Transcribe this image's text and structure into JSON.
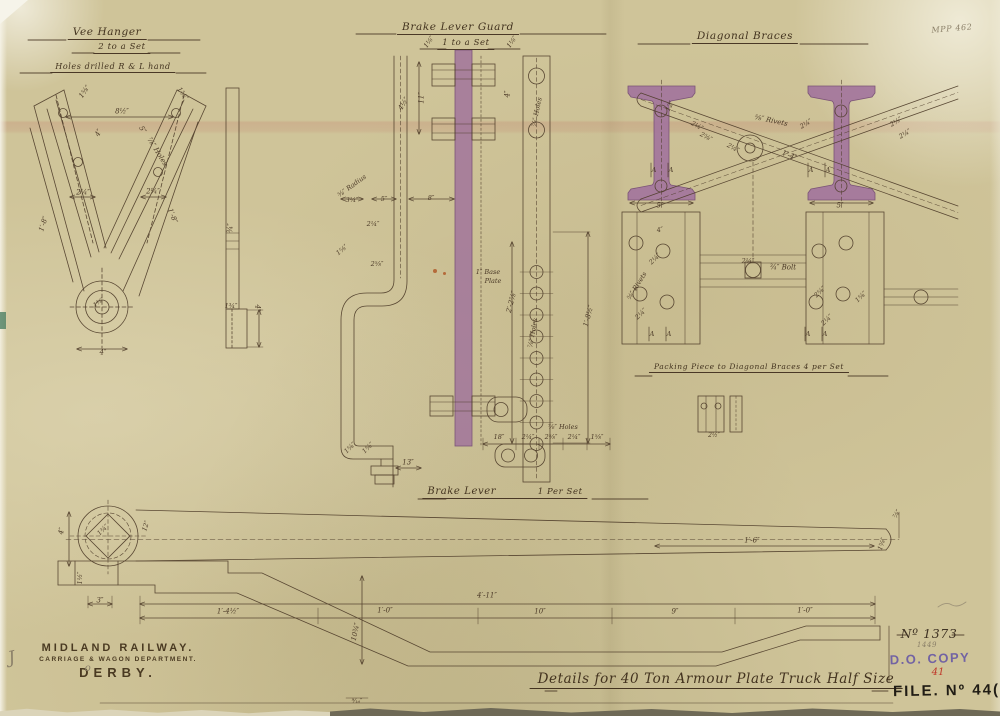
{
  "sheet": {
    "corner_note": "MPP 462",
    "pencil_mark_1": "J",
    "pencil_mark_2": "o"
  },
  "sections": {
    "vee_hanger": {
      "title": "Vee Hanger",
      "subtitle": "2 to a Set",
      "note": "Holes drilled R & L hand"
    },
    "brake_lever_guard": {
      "title": "Brake Lever Guard",
      "subtitle": "1 to a Set"
    },
    "diagonal_braces": {
      "title": "Diagonal Braces"
    },
    "packing_piece": {
      "label": "Packing Piece to Diagonal Braces    4 per Set"
    },
    "brake_lever": {
      "title": "Brake Lever",
      "subtitle": "1 Per Set"
    }
  },
  "title_block": {
    "company": "MIDLAND RAILWAY.",
    "department": "CARRIAGE & WAGON DEPARTMENT.",
    "location": "DERBY.",
    "main_title": "Details for 40 Ton Armour Plate Truck    Half Size"
  },
  "stamps": {
    "drawing_number": "Nº 1373",
    "pencil_number": "1449",
    "do_copy": "D.O. COPY",
    "red_note": "41",
    "file_stamp": "FILE. Nº 44(XX"
  },
  "colors": {
    "paper": "#cfc499",
    "ink": "#4f3d2a",
    "highlight_mauve": "#a1749b",
    "stamp_purple": "#6656a5",
    "stamp_red": "#c0392b"
  },
  "annotations": [
    {
      "text": "1⅝″",
      "x": 85,
      "y": 92,
      "rot": -55
    },
    {
      "text": "1⅝″",
      "x": 182,
      "y": 94,
      "rot": 55
    },
    {
      "text": "8½″",
      "x": 122,
      "y": 112
    },
    {
      "text": "4″",
      "x": 99,
      "y": 133,
      "rot": -62
    },
    {
      "text": "5″",
      "x": 142,
      "y": 130,
      "rot": 58
    },
    {
      "text": "⅞″ Holes",
      "x": 157,
      "y": 152,
      "rot": 58
    },
    {
      "text": "2¼″",
      "x": 83,
      "y": 193
    },
    {
      "text": "2¼″",
      "x": 153,
      "y": 192
    },
    {
      "text": "1′-8″",
      "x": 44,
      "y": 224,
      "rot": -72
    },
    {
      "text": "1′-8″",
      "x": 172,
      "y": 216,
      "rot": 68
    },
    {
      "text": "1⅜″",
      "x": 99,
      "y": 303,
      "rot": -35,
      "size": 6
    },
    {
      "text": "4″",
      "x": 103,
      "y": 353
    },
    {
      "text": "¾″",
      "x": 231,
      "y": 228,
      "rot": -90
    },
    {
      "text": "1¾″",
      "x": 231,
      "y": 306,
      "size": 6.5
    },
    {
      "text": "4″",
      "x": 257,
      "y": 308,
      "rot": 90
    },
    {
      "text": "1⅛″",
      "x": 429,
      "y": 42,
      "rot": -55,
      "size": 6.5
    },
    {
      "text": "1⅛″",
      "x": 512,
      "y": 42,
      "rot": -55,
      "size": 6.5
    },
    {
      "text": "4½″",
      "x": 404,
      "y": 104,
      "rot": -58
    },
    {
      "text": "11″",
      "x": 422,
      "y": 98,
      "rot": -90
    },
    {
      "text": "4″",
      "x": 508,
      "y": 94,
      "rot": -90
    },
    {
      "text": "⅞″ Holes",
      "x": 537,
      "y": 112,
      "rot": -78,
      "size": 6.5
    },
    {
      "text": "⅝″ Radius",
      "x": 352,
      "y": 186,
      "rot": -36,
      "size": 6.5
    },
    {
      "text": "3¼″",
      "x": 352,
      "y": 200,
      "size": 6.5
    },
    {
      "text": "5″",
      "x": 384,
      "y": 199,
      "size": 6.5
    },
    {
      "text": "8″",
      "x": 431,
      "y": 198,
      "size": 6.5
    },
    {
      "text": "2¼″",
      "x": 373,
      "y": 224,
      "size": 6.5
    },
    {
      "text": "1⅝″",
      "x": 342,
      "y": 250,
      "rot": -40,
      "size": 6.5
    },
    {
      "text": "2⅝″",
      "x": 377,
      "y": 264,
      "size": 6.5
    },
    {
      "text": "2′-2⅞″",
      "x": 512,
      "y": 302,
      "rot": -75
    },
    {
      "text": "⅞″ Holes",
      "x": 533,
      "y": 333,
      "rot": -80,
      "size": 6.5
    },
    {
      "text": "1′-8½″",
      "x": 589,
      "y": 316,
      "rot": -75
    },
    {
      "text": "1″ Base",
      "x": 488,
      "y": 272,
      "size": 6.5
    },
    {
      "text": "Plate",
      "x": 493,
      "y": 281,
      "size": 6.5
    },
    {
      "text": "⅞″ Holes",
      "x": 563,
      "y": 427,
      "size": 6.5
    },
    {
      "text": "1⅝″",
      "x": 350,
      "y": 448,
      "rot": -45,
      "size": 6.5
    },
    {
      "text": "1⅝″",
      "x": 368,
      "y": 448,
      "rot": -45,
      "size": 6.5
    },
    {
      "text": "13″",
      "x": 408,
      "y": 463
    },
    {
      "text": "18″",
      "x": 499,
      "y": 437,
      "size": 6.5
    },
    {
      "text": "2¼″",
      "x": 528,
      "y": 437,
      "size": 6.5
    },
    {
      "text": "2⅝″",
      "x": 551,
      "y": 437,
      "size": 6.5
    },
    {
      "text": "2¼″",
      "x": 574,
      "y": 437,
      "size": 6.5
    },
    {
      "text": "1⅝″",
      "x": 597,
      "y": 437,
      "size": 6.5
    },
    {
      "text": "12″",
      "x": 670,
      "y": 106,
      "rot": -65,
      "size": 6.5
    },
    {
      "text": "2¼″",
      "x": 697,
      "y": 126,
      "rot": 28,
      "size": 6.5
    },
    {
      "text": "2⅝″",
      "x": 706,
      "y": 137,
      "rot": 28,
      "size": 6.5
    },
    {
      "text": "⅝″ Rivets",
      "x": 771,
      "y": 121,
      "rot": 12
    },
    {
      "text": "2¼″",
      "x": 733,
      "y": 148,
      "rot": 28,
      "size": 6.5
    },
    {
      "text": "1′-4″",
      "x": 789,
      "y": 156,
      "rot": 22
    },
    {
      "text": "2¼″",
      "x": 806,
      "y": 124,
      "rot": -32,
      "size": 6.5
    },
    {
      "text": "2⅛″",
      "x": 896,
      "y": 122,
      "rot": -32,
      "size": 6.5
    },
    {
      "text": "2¼″",
      "x": 905,
      "y": 134,
      "rot": -32,
      "size": 6.5
    },
    {
      "text": "A",
      "x": 654,
      "y": 170,
      "size": 6.5
    },
    {
      "text": "A",
      "x": 671,
      "y": 170,
      "size": 6.5
    },
    {
      "text": "A",
      "x": 811,
      "y": 170,
      "size": 6.5
    },
    {
      "text": "A",
      "x": 828,
      "y": 170,
      "size": 6.5
    },
    {
      "text": "5″",
      "x": 660,
      "y": 206
    },
    {
      "text": "5″",
      "x": 840,
      "y": 206
    },
    {
      "text": "⅝″ Rivets",
      "x": 637,
      "y": 286,
      "rot": -58,
      "size": 6.5
    },
    {
      "text": "2¼″",
      "x": 655,
      "y": 259,
      "rot": -45,
      "size": 6.5
    },
    {
      "text": "¾″ Bolt",
      "x": 783,
      "y": 268
    },
    {
      "text": "2¼″",
      "x": 748,
      "y": 261,
      "size": 6.5
    },
    {
      "text": "4″",
      "x": 660,
      "y": 230,
      "rot": -12,
      "size": 6.5
    },
    {
      "text": "2⅝″",
      "x": 820,
      "y": 292,
      "rot": -45,
      "size": 6.5
    },
    {
      "text": "1⅝″",
      "x": 861,
      "y": 297,
      "rot": -45,
      "size": 6.5
    },
    {
      "text": "2¼″",
      "x": 641,
      "y": 314,
      "rot": -45,
      "size": 6.5
    },
    {
      "text": "2¼″",
      "x": 827,
      "y": 320,
      "rot": -45,
      "size": 6.5
    },
    {
      "text": "A",
      "x": 652,
      "y": 334,
      "size": 6.5
    },
    {
      "text": "A",
      "x": 669,
      "y": 334,
      "size": 6.5
    },
    {
      "text": "A",
      "x": 808,
      "y": 334,
      "size": 6.5
    },
    {
      "text": "A",
      "x": 825,
      "y": 334,
      "size": 6.5
    },
    {
      "text": "2½″",
      "x": 714,
      "y": 436,
      "size": 6
    },
    {
      "text": "4″",
      "x": 62,
      "y": 531,
      "rot": -80
    },
    {
      "text": "1¾″",
      "x": 103,
      "y": 530,
      "rot": -45,
      "size": 6.5
    },
    {
      "text": "12″",
      "x": 146,
      "y": 526,
      "rot": -72,
      "size": 6.5
    },
    {
      "text": "1′-6″",
      "x": 752,
      "y": 541
    },
    {
      "text": "⅞″",
      "x": 897,
      "y": 514,
      "rot": -60,
      "size": 6.5
    },
    {
      "text": "1⅝″",
      "x": 882,
      "y": 544,
      "rot": -72,
      "size": 6.5
    },
    {
      "text": "1½″",
      "x": 80,
      "y": 578,
      "rot": -90,
      "size": 6.5
    },
    {
      "text": "3″",
      "x": 100,
      "y": 601
    },
    {
      "text": "1′-4½″",
      "x": 228,
      "y": 612
    },
    {
      "text": "1′-0″",
      "x": 385,
      "y": 611
    },
    {
      "text": "4′-11″",
      "x": 487,
      "y": 596
    },
    {
      "text": "10″",
      "x": 540,
      "y": 612
    },
    {
      "text": "9″",
      "x": 675,
      "y": 612
    },
    {
      "text": "1′-0″",
      "x": 805,
      "y": 611
    },
    {
      "text": "10¾″",
      "x": 356,
      "y": 632,
      "rot": -78
    },
    {
      "text": "⁹⁄₁₆″",
      "x": 357,
      "y": 702,
      "size": 6
    }
  ]
}
